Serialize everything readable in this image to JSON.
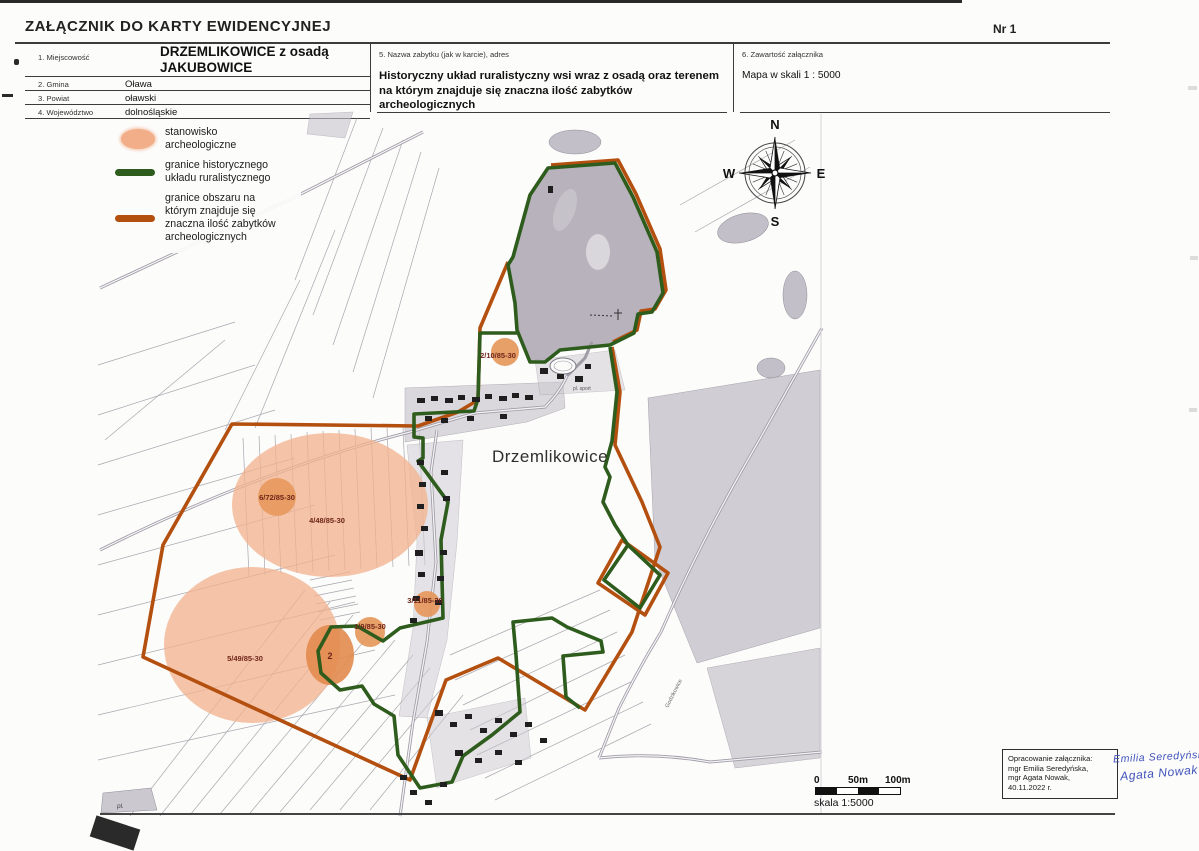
{
  "header": {
    "title": "ZAŁĄCZNIK DO KARTY EWIDENCYJNEJ",
    "number": "Nr 1"
  },
  "form": {
    "fields": [
      {
        "label": "1. Miejscowość",
        "value": "DRZEMLIKOWICE z osadą JAKUBOWICE"
      },
      {
        "label": "2. Gmina",
        "value": "Oława"
      },
      {
        "label": "3. Powiat",
        "value": "oławski"
      },
      {
        "label": "4. Województwo",
        "value": "dolnośląskie"
      }
    ],
    "monument": {
      "label": "5. Nazwa zabytku (jak w karcie), adres",
      "value": "Historyczny układ ruralistyczny wsi wraz z osadą oraz terenem na którym znajduje się znaczna ilość zabytków archeologicznych"
    },
    "attachment": {
      "label": "6. Zawartość załącznika",
      "value": "Mapa w skali 1 : 5000"
    }
  },
  "legend": {
    "items": [
      {
        "label": "stanowisko archeologiczne"
      },
      {
        "label": "granice historycznego układu ruralistycznego"
      },
      {
        "label": "granice obszaru na którym znajduje się znaczna ilość zabytków archeologicznych"
      }
    ]
  },
  "compass": {
    "n": "N",
    "e": "E",
    "s": "S",
    "w": "W"
  },
  "map": {
    "village_label": "Drzemlikowice",
    "sites": [
      {
        "id": "2/10/85-30"
      },
      {
        "id": "6/72/85-30"
      },
      {
        "id": "4/48/85-30"
      },
      {
        "id": "5/49/85-30"
      },
      {
        "id": "1/9/85-30"
      },
      {
        "id": "3/11/85-30"
      },
      {
        "id": "2"
      }
    ],
    "minor_labels": {
      "pl": "pl.",
      "sport": "pl. sport",
      "road": "Godzikowice"
    }
  },
  "scalebar": {
    "ticks": [
      "0",
      "50m",
      "100m"
    ],
    "caption": "skala 1:5000"
  },
  "attribution": {
    "lines": [
      "Opracowanie załącznika:",
      "mgr Emilia Seredyńska,",
      "mgr Agata Nowak,",
      "40.11.2022 r."
    ]
  },
  "signatures": [
    "Emilia Seredyńska",
    "Agata Nowak"
  ],
  "colors": {
    "site_fill": "#f2ae88",
    "historic_boundary": "#2e5c1d",
    "archaeological_area_boundary": "#b4500f"
  }
}
